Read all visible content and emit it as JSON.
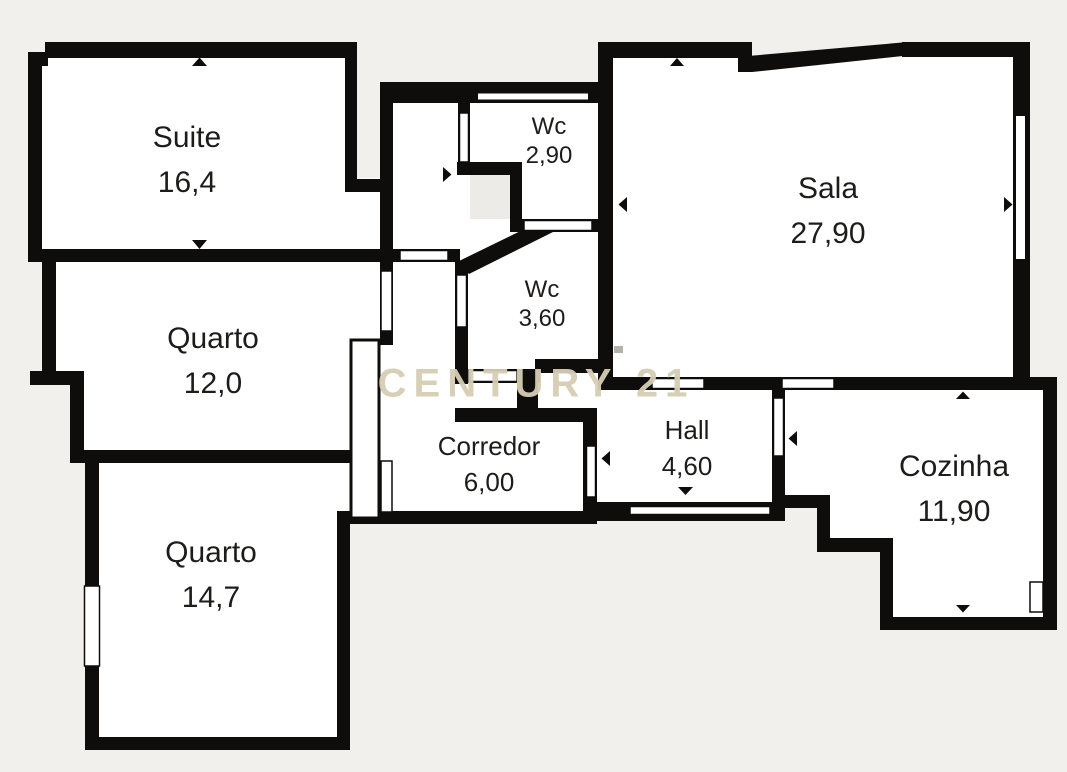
{
  "floorplan": {
    "watermark": "CENTURY 21",
    "rooms": [
      {
        "name": "Suite",
        "area": "16,4"
      },
      {
        "name": "Quarto",
        "area": "12,0"
      },
      {
        "name": "Quarto",
        "area": "14,7"
      },
      {
        "name": "Wc",
        "area": "2,90"
      },
      {
        "name": "Wc",
        "area": "3,60"
      },
      {
        "name": "Corredor",
        "area": "6,00"
      },
      {
        "name": "Hall",
        "area": "4,60"
      },
      {
        "name": "Sala",
        "area": "27,90"
      },
      {
        "name": "Cozinha",
        "area": "11,90"
      }
    ],
    "colors": {
      "wall": "#0e0d0b",
      "room_fill": "#ffffff",
      "exterior": "#f2f0ed",
      "watermark": "#d6cdb4",
      "label_text": "#1d1c1a"
    }
  }
}
